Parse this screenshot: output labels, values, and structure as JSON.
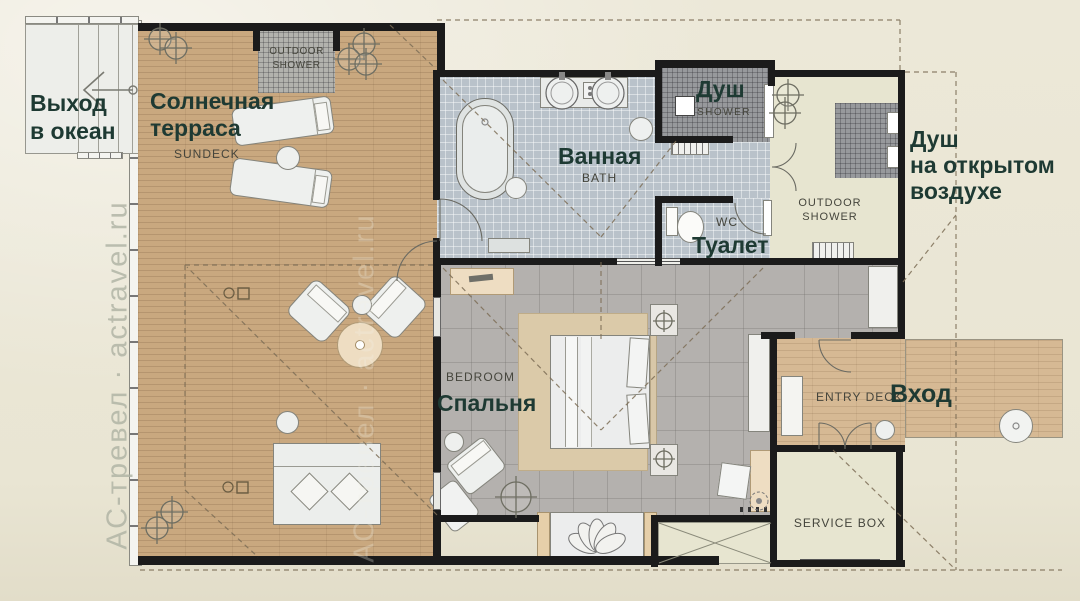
{
  "watermark": "АС-тревел · actravel.ru",
  "colors": {
    "wall": "#1b1b1b",
    "label_accent": "#1e3a33",
    "label_secondary": "#45453c",
    "deck_wood": "#c9a87f",
    "entry_wood": "#d6b994",
    "bath_tile": "#b9c2ca",
    "shower_mosaic": "#97999c",
    "bedroom_floor": "#b4b1ae",
    "room_beige": "#e7e5d0",
    "canvas": "#e9e5d3"
  },
  "rooms": [
    {
      "id": "ocean-exit",
      "ru_lines": [
        "Выход",
        "в океан"
      ]
    },
    {
      "id": "sundeck",
      "ru_lines": [
        "Солнечная",
        "терраса"
      ],
      "en": "SUNDECK"
    },
    {
      "id": "outdoor-shower-top",
      "en_lines": [
        "OUTDOOR",
        "SHOWER"
      ]
    },
    {
      "id": "bath",
      "ru": "Ванная",
      "en": "BATH"
    },
    {
      "id": "shower",
      "ru": "Душ",
      "en": "SHOWER"
    },
    {
      "id": "wc",
      "ru": "Туалет",
      "en": "WC"
    },
    {
      "id": "outdoor-shower-right",
      "ru_lines": [
        "Душ",
        "на открытом",
        "воздухе"
      ],
      "en_lines": [
        "OUTDOOR",
        "SHOWER"
      ]
    },
    {
      "id": "bedroom",
      "ru": "Спальня",
      "en": "BEDROOM"
    },
    {
      "id": "entry",
      "ru": "Вход",
      "en": "ENTRY DECK"
    },
    {
      "id": "service-box",
      "en": "SERVICE BOX"
    }
  ]
}
